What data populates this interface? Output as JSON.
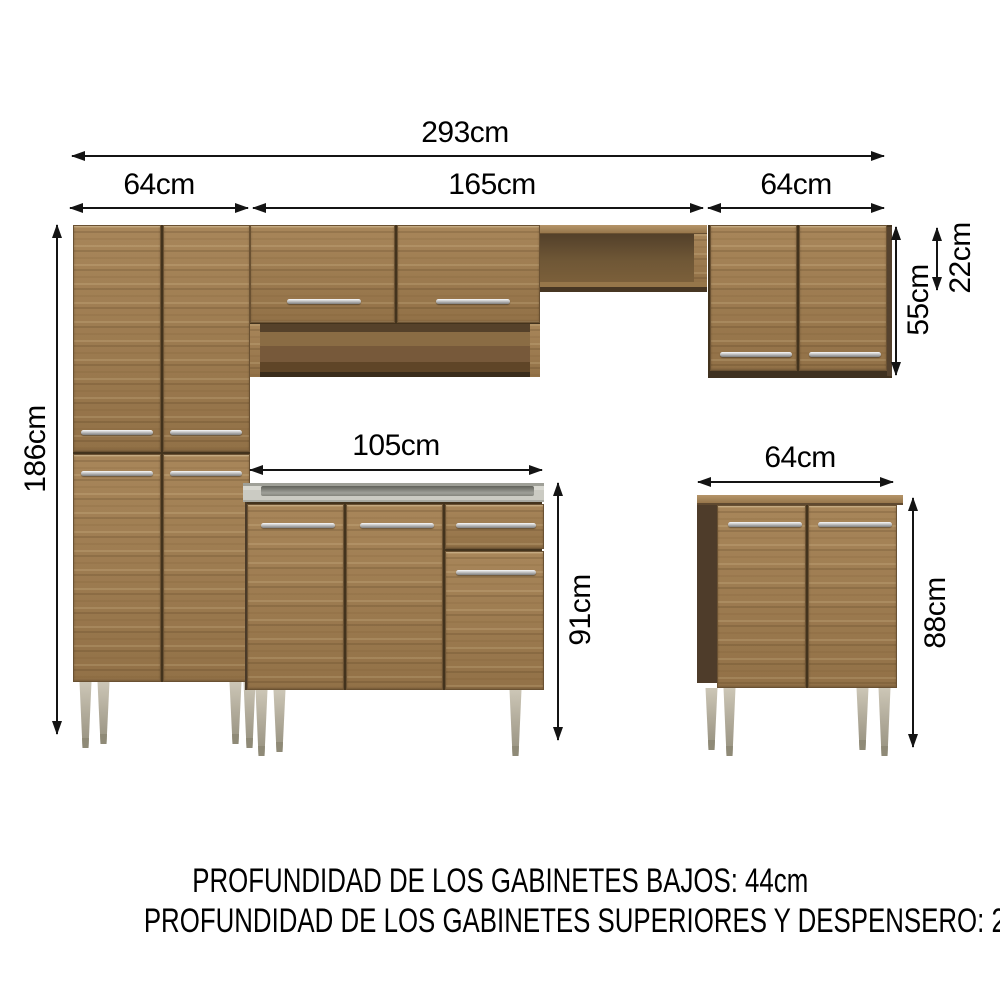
{
  "dimensions": {
    "total_width": "293cm",
    "pantry_width": "64cm",
    "upper_row_width": "165cm",
    "upper_right_width": "64cm",
    "pantry_height": "186cm",
    "upper_cabinet_height": "55cm",
    "open_shelf_height": "22cm",
    "counter_cabinet_width": "105cm",
    "counter_cabinet_height": "91cm",
    "base_cabinet_width": "64cm",
    "base_cabinet_height": "88cm"
  },
  "notes": {
    "base_depth": "PROFUNDIDAD DE LOS GABINETES BAJOS: 44cm",
    "upper_depth": "PROFUNDIDAD DE LOS GABINETES SUPERIORES Y DESPENSERO: 27cm"
  },
  "colors": {
    "wood": "#9e7c50",
    "wood_dark_side": "#4e3c2a",
    "wood_interior": "#6b5334",
    "countertop": "#cdcdc5",
    "handle_metal": "#c7c7c7",
    "leg_metal": "#b8b2a2",
    "dimension_line": "#141414",
    "background": "#ffffff"
  }
}
